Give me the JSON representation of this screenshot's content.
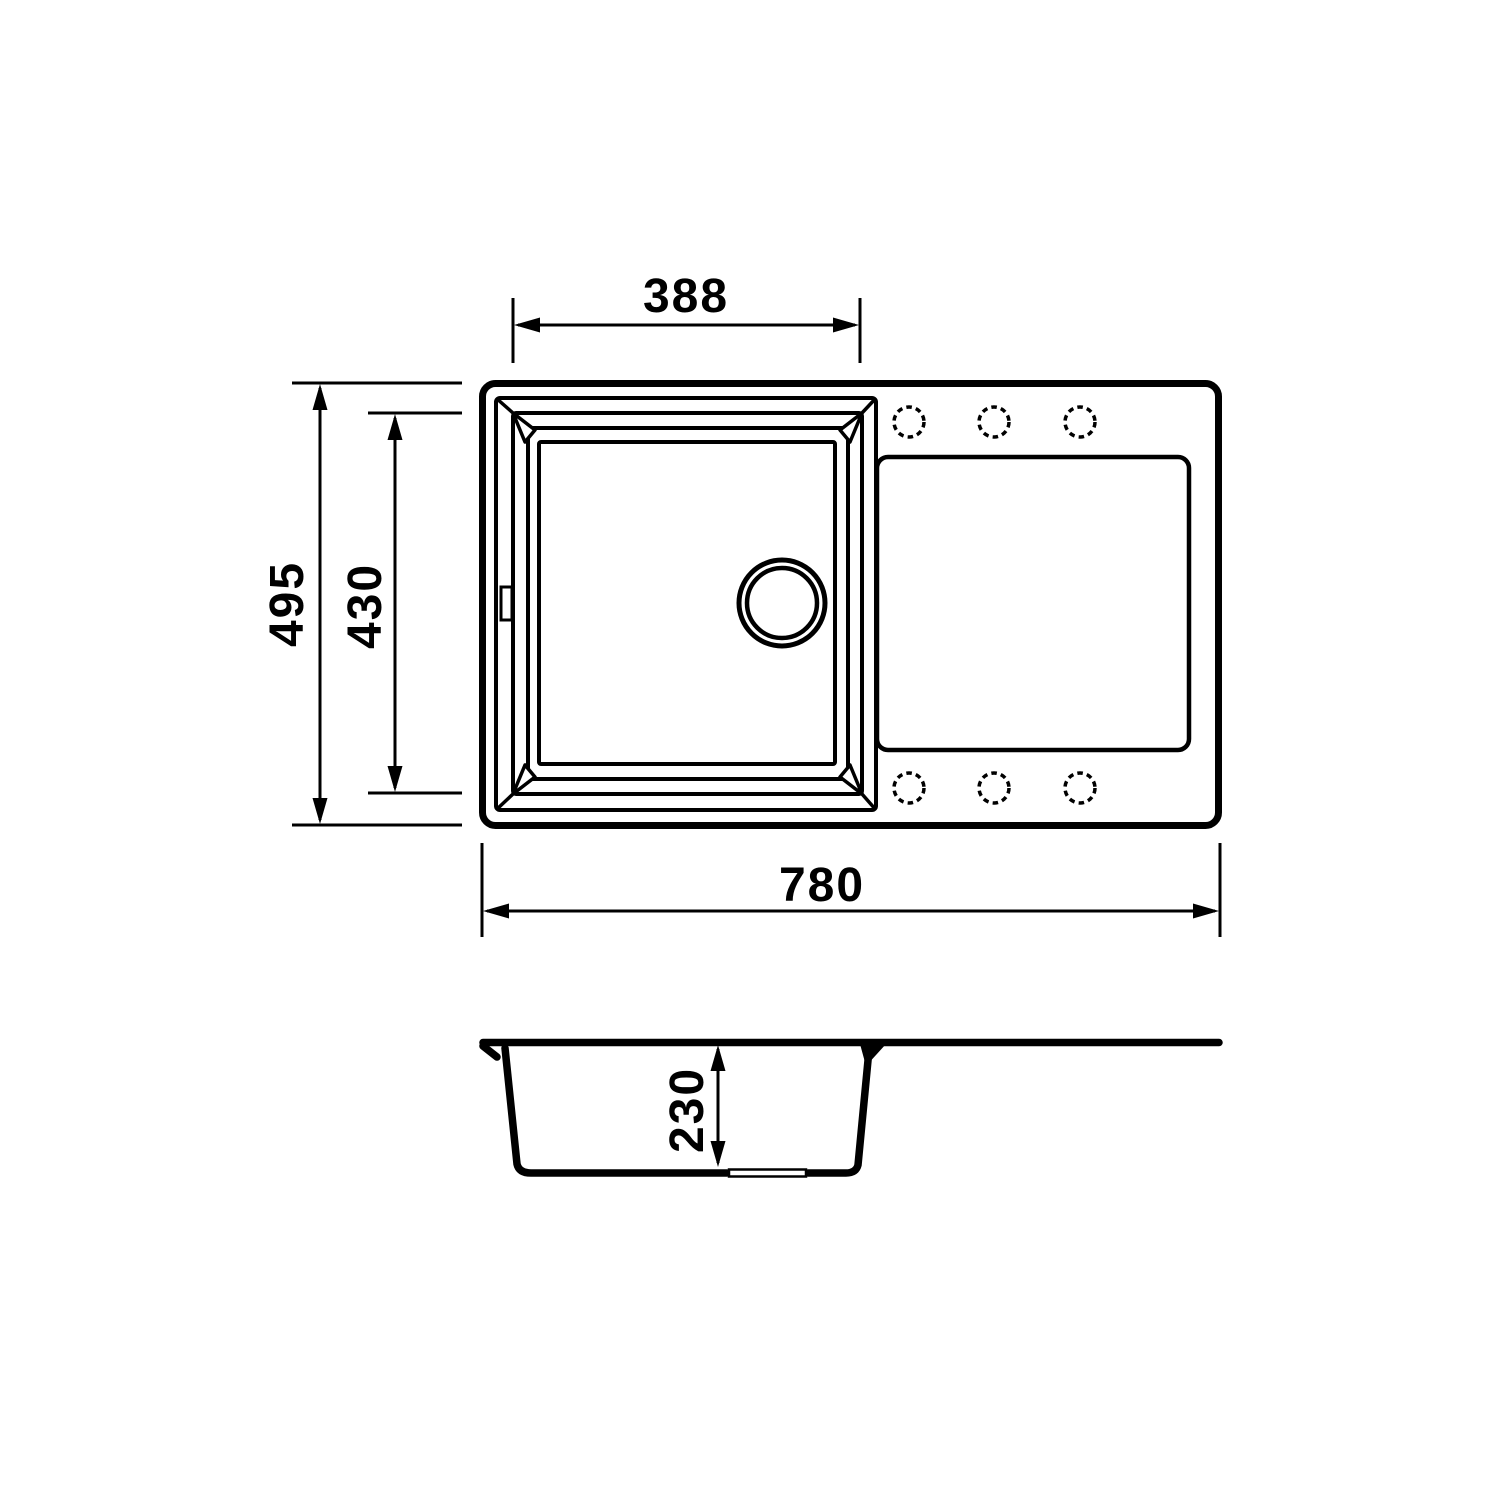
{
  "colors": {
    "line": "#000000",
    "bg": "#ffffff"
  },
  "top_view": {
    "dim_bowl_width": "388",
    "dim_overall_depth": "495",
    "dim_bowl_depth": "430",
    "dim_overall_width": "780"
  },
  "section_view": {
    "dim_bowl_height": "230"
  }
}
